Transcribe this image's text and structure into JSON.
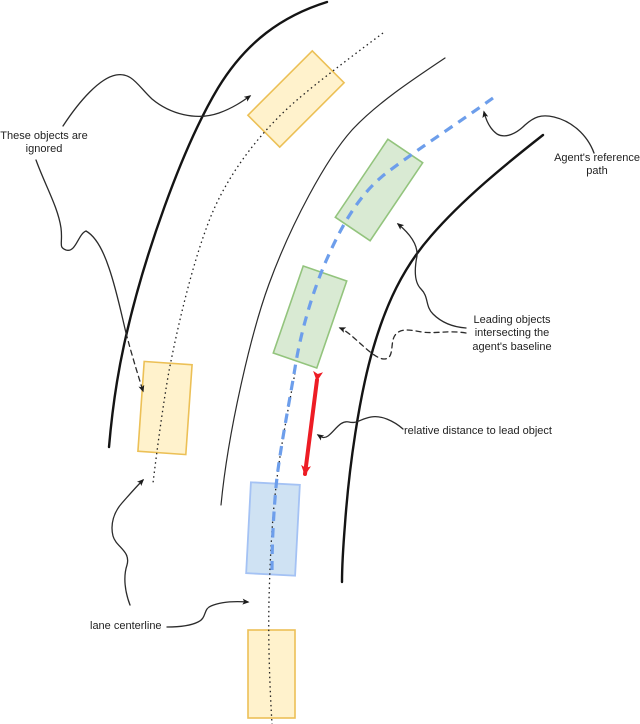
{
  "diagram": {
    "title": "Agent reference path and leading objects on a curved multi-lane road",
    "canvas": {
      "width": 640,
      "height": 724,
      "background": "#ffffff"
    },
    "labels": {
      "ignored": "These objects are\nignored",
      "reference_path": "Agent's reference\npath",
      "leading_objects": "Leading objects\nintersecting the\nagent's baseline",
      "relative_distance": "relative distance to lead object",
      "lane_centerline": "lane centerline"
    },
    "colors": {
      "ignored_vehicle_fill": "#fff2cc",
      "ignored_vehicle_stroke": "#ecc056",
      "leading_vehicle_fill": "#d9ead3",
      "leading_vehicle_stroke": "#93c47d",
      "agent_vehicle_fill": "#cfe2f3",
      "agent_vehicle_stroke": "#a4c2f4",
      "reference_path": "#6d9eeb",
      "distance_arrow": "#ed1c24",
      "road_lines": "#141414",
      "text": "#1f1f1f"
    },
    "vehicles": [
      {
        "id": "ignored-top",
        "role": "ignored object (adjacent lane, ahead)",
        "color": "yellow"
      },
      {
        "id": "ignored-mid",
        "role": "ignored object (adjacent lane)",
        "color": "yellow"
      },
      {
        "id": "ignored-bottom",
        "role": "ignored object (behind agent)",
        "color": "yellow"
      },
      {
        "id": "leading-1",
        "role": "leading object intersecting agent's baseline (far)",
        "color": "green"
      },
      {
        "id": "leading-2",
        "role": "leading object intersecting agent's baseline (near)",
        "color": "green"
      },
      {
        "id": "agent",
        "role": "agent vehicle on reference path",
        "color": "blue"
      }
    ],
    "annotations": [
      {
        "label": "These objects are ignored",
        "points_to": [
          "ignored-top",
          "ignored-mid"
        ]
      },
      {
        "label": "Agent's reference path",
        "points_to": [
          "reference-path"
        ]
      },
      {
        "label": "Leading objects intersecting the agent's baseline",
        "points_to": [
          "leading-1",
          "leading-2"
        ]
      },
      {
        "label": "relative distance to lead object",
        "points_to": [
          "distance-arrow"
        ]
      },
      {
        "label": "lane centerline",
        "points_to": [
          "left-lane-centerline",
          "agent-lane-centerline"
        ]
      }
    ]
  }
}
